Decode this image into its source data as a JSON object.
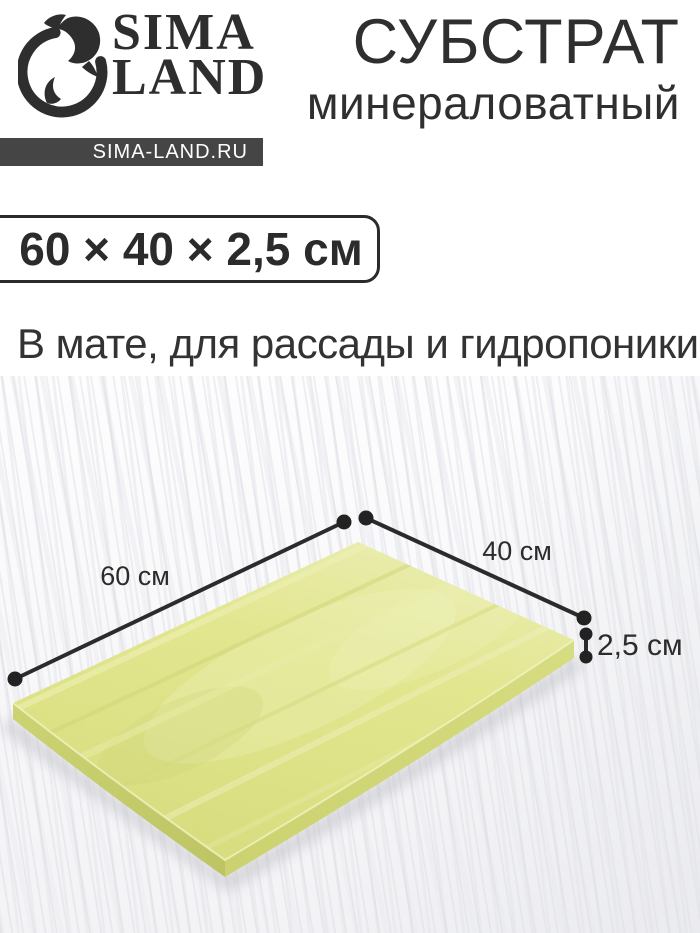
{
  "brand": {
    "line1": "SIMA",
    "line2": "LAND",
    "site": "SIMA-LAND.RU",
    "icon": "dolphin-logo-icon"
  },
  "header": {
    "title": "СУБСТРАТ",
    "subtitle": "минераловатный"
  },
  "product": {
    "size_label": "60 × 40 × 2,5 см",
    "description": "В мате, для рассады и гидропоники"
  },
  "dimensions": {
    "length": "60 см",
    "width": "40 см",
    "thickness": "2,5 см"
  },
  "colors": {
    "text_dark": "#2e2e2e",
    "badge_bg": "#454545",
    "badge_text": "#ffffff",
    "size_box_border": "#2b2b2b",
    "annotation": "#2b2b2b",
    "mat_top": "#e2e68f",
    "mat_side": "#c6cd6b",
    "background": "#ffffff"
  }
}
